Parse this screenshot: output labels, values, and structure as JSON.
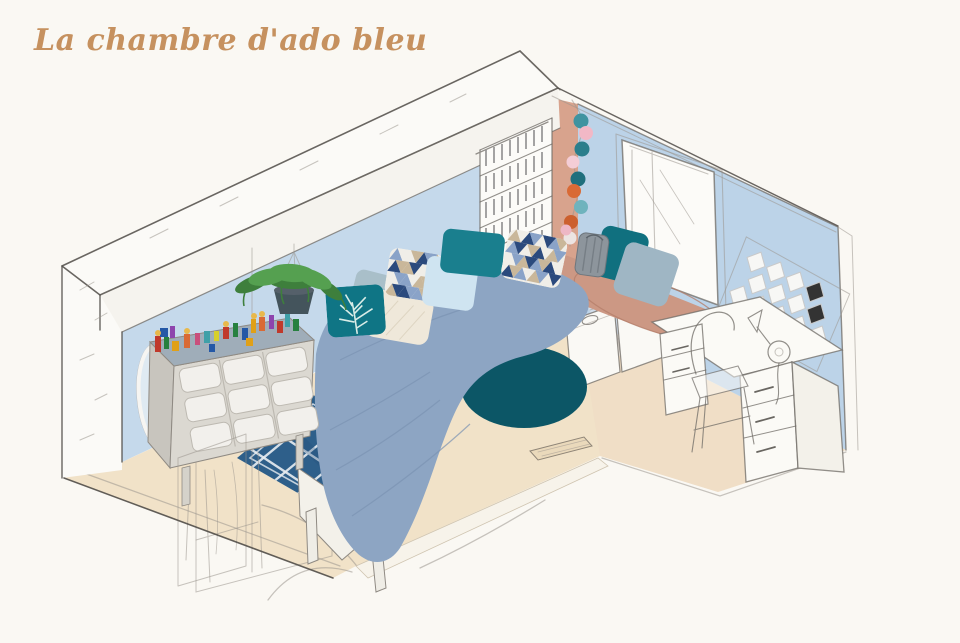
{
  "title": {
    "text": "La chambre d'ado bleu",
    "color": "#c6915f"
  },
  "canvas": {
    "background": "#faf8f3",
    "pencil": "#6f6b66"
  },
  "room": {
    "wall_left": "#c5d9eb",
    "wall_right": "#bcd3e8",
    "wall_accent_terracotta": "#d8a38d",
    "floor": "#f1e2c8",
    "floor_right_tint": "#eedbc4",
    "floor_threshold": "#f7f3ea",
    "beam_white": "#fbfaf7",
    "beam_face": "#f5f3ee",
    "wall_end_cap": "#fbfaf7"
  },
  "furniture": {
    "duvet": "#8da5c3",
    "duvet_fold": "#7b93b2",
    "bed_base": "#f3f1ea",
    "seat_cushion": "#cc9884",
    "seat_cushion_line": "#b57f6b",
    "toy_unit_top": "#9fadb9",
    "toy_unit_body": "#dbd8d1",
    "toy_unit_side": "#c8c5be",
    "toy_unit_bin": "#f2f0ec",
    "basket": "#8d959c",
    "mirror": "#dfeaf2",
    "desk_white": "#fbfaf6",
    "desk_side": "#f3f1ea",
    "sketch_wash": "#e3e8ec"
  },
  "textiles": {
    "rug_round": "#0c5666",
    "rug_navy": "#2e5f8a",
    "rug_navy_shade": "#23517a",
    "rug_lattice": "#e9edf1",
    "pillow_teal": "#1a7f8e",
    "pillow_teal_dark": "#10707f",
    "pillow_tree": "#0f7585",
    "pillow_tree_print": "#d8ece7",
    "pillow_light_blue": "#cfe4f1",
    "pillow_cream": "#efe8da",
    "pillow_gray_blue": "#a9bfc9",
    "pillow_seat_gray": "#9fb6c4",
    "triangle_navy": "#2b4a7d",
    "triangle_steel": "#8aa3c8",
    "triangle_tan": "#c9b79a",
    "triangle_white": "#f0eee8"
  },
  "decor": {
    "plant_green": "#55a050",
    "plant_green_dark": "#3e7f3c",
    "plant_pot": "#44545c",
    "hex_tile": "#f7f7f5",
    "hex_tile_dark": "#333333",
    "window_white": "#fcfbf8",
    "pink_ball": "#eeb7c5"
  },
  "lights": {
    "balls": [
      {
        "color": "#3f93a0"
      },
      {
        "color": "#f2b8c6"
      },
      {
        "color": "#2a7e8c"
      },
      {
        "color": "#f4cdd6"
      },
      {
        "color": "#1f6f7d"
      },
      {
        "color": "#d96a35"
      },
      {
        "color": "#6fb3bd"
      },
      {
        "color": "#cc5f2e"
      },
      {
        "color": "#ece4e2"
      }
    ]
  },
  "lego": [
    "#c0392b",
    "#27803f",
    "#e0a018",
    "#2458a6",
    "#8e44ad",
    "#d96a35",
    "#c94f7c",
    "#3fa0a8",
    "#d8cf2a",
    "#c0392b",
    "#27803f",
    "#2458a6",
    "#e0a018",
    "#d96a35",
    "#8e44ad",
    "#c0392b",
    "#3fa0a8",
    "#27803f",
    "#e0a018",
    "#2458a6"
  ]
}
